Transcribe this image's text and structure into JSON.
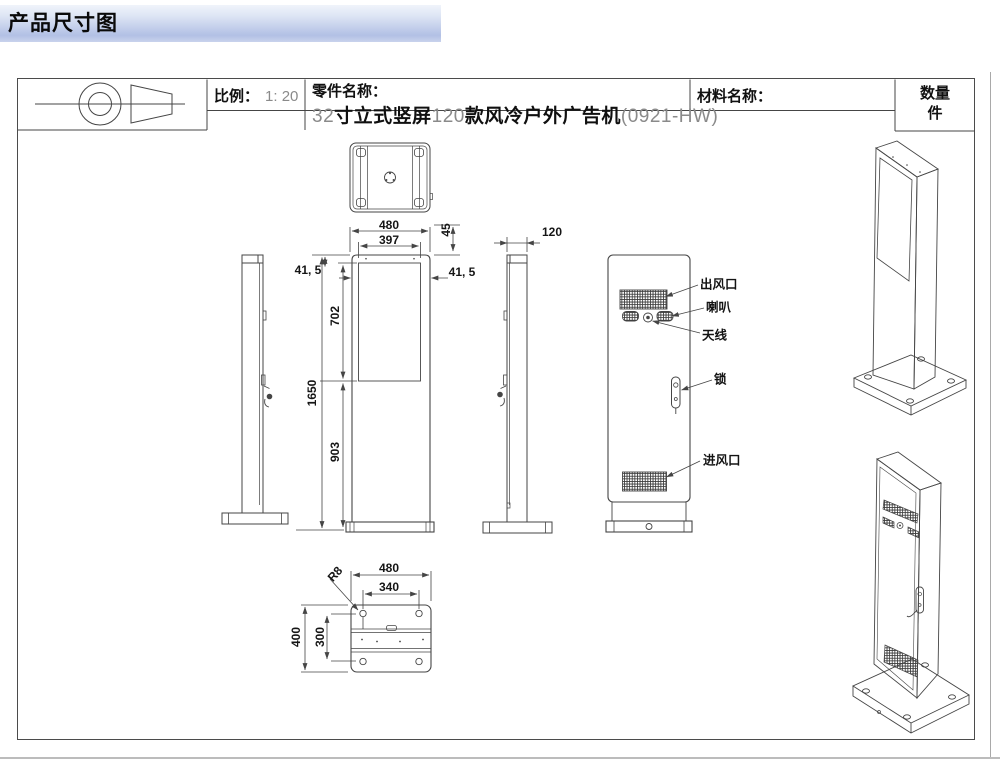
{
  "banner": {
    "title": "产品尺寸图"
  },
  "title_block": {
    "scale_label": "比例：",
    "scale_value": "1: 20",
    "part_label": "零件名称：",
    "part_name_segments": [
      {
        "text": "32",
        "style": "num"
      },
      {
        "text": "寸立式竖屏",
        "style": "cn"
      },
      {
        "text": "120",
        "style": "num"
      },
      {
        "text": "款风冷户外广告机",
        "style": "cn"
      },
      {
        "text": "(0921-HW)",
        "style": "num"
      }
    ],
    "material_label": "材料名称：",
    "quantity_label": "数量",
    "quantity_unit": "件"
  },
  "dimensions": {
    "top_width": "480",
    "screen_width": "397",
    "top_inset": "45",
    "side_inset_left": "41, 5",
    "side_inset_right": "41, 5",
    "screen_height": "702",
    "total_height": "1650",
    "lower_height": "903",
    "depth": "120",
    "base_width": "480",
    "bolt_spacing_x": "340",
    "corner_radius": "R8",
    "base_depth": "400",
    "bolt_spacing_y": "300"
  },
  "feature_labels": {
    "air_outlet": "出风口",
    "speaker": "喇叭",
    "antenna": "天线",
    "lock": "锁",
    "air_inlet": "进风口"
  },
  "colors": {
    "line": "#454545",
    "banner_bottom": "#b2c0e5",
    "dim_text": "#151515"
  }
}
